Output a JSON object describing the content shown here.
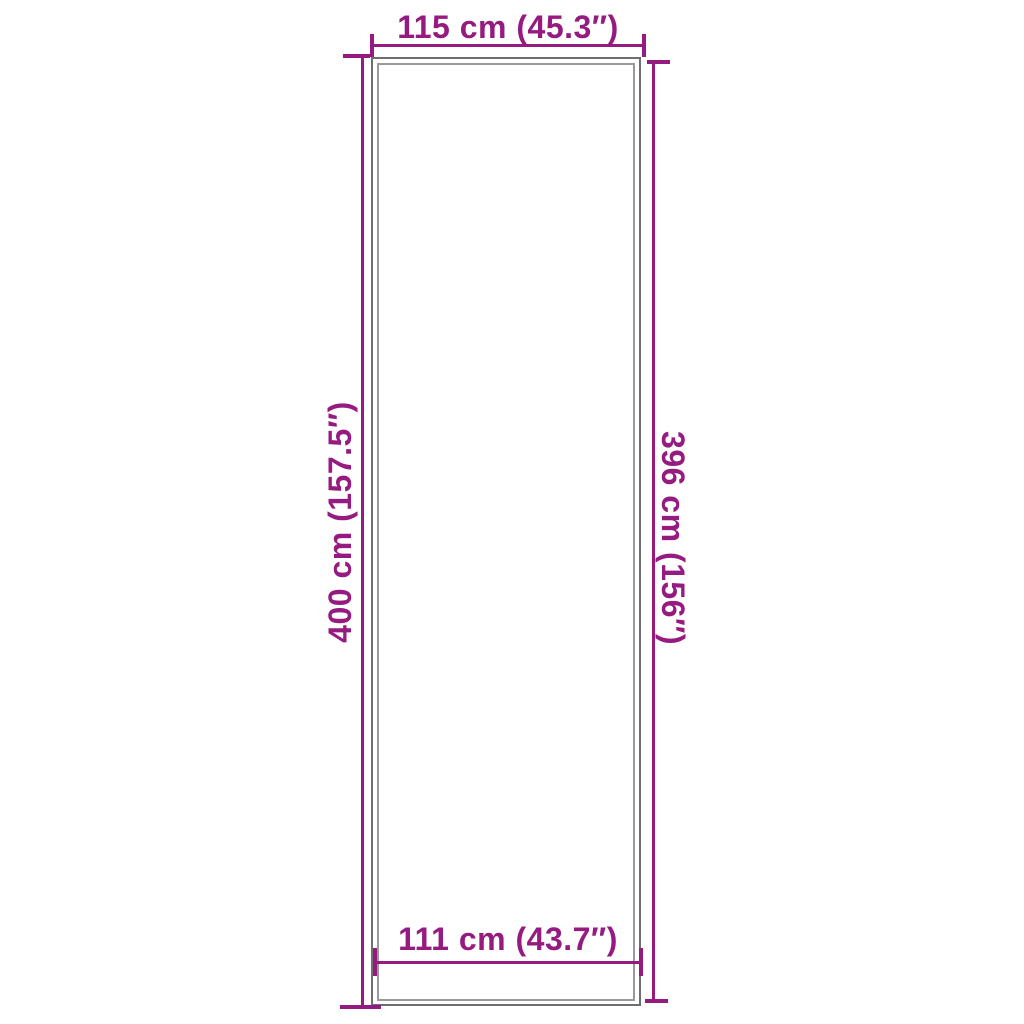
{
  "diagram": {
    "type": "product-dimension-diagram",
    "product_shape": "tall-rectangle-with-double-outline",
    "dimensions": {
      "top": {
        "label": "115 cm (45.3″)",
        "cm": 115,
        "inches": 45.3,
        "edge": "outer-width-top"
      },
      "bottom": {
        "label": "111 cm (43.7″)",
        "cm": 111,
        "inches": 43.7,
        "edge": "inner-width-bottom"
      },
      "left": {
        "label": "400 cm (157.5″)",
        "cm": 400,
        "inches": 157.5,
        "edge": "outer-height-left"
      },
      "right": {
        "label": "396 cm (156″)",
        "cm": 396,
        "inches": 156,
        "edge": "inner-height-right"
      }
    },
    "colors": {
      "dimension_accent": "#951B81",
      "outline_outer_grey": "#6F6F6F",
      "outline_inner_grey": "#9A9A9A",
      "background": "#FFFFFF"
    }
  }
}
